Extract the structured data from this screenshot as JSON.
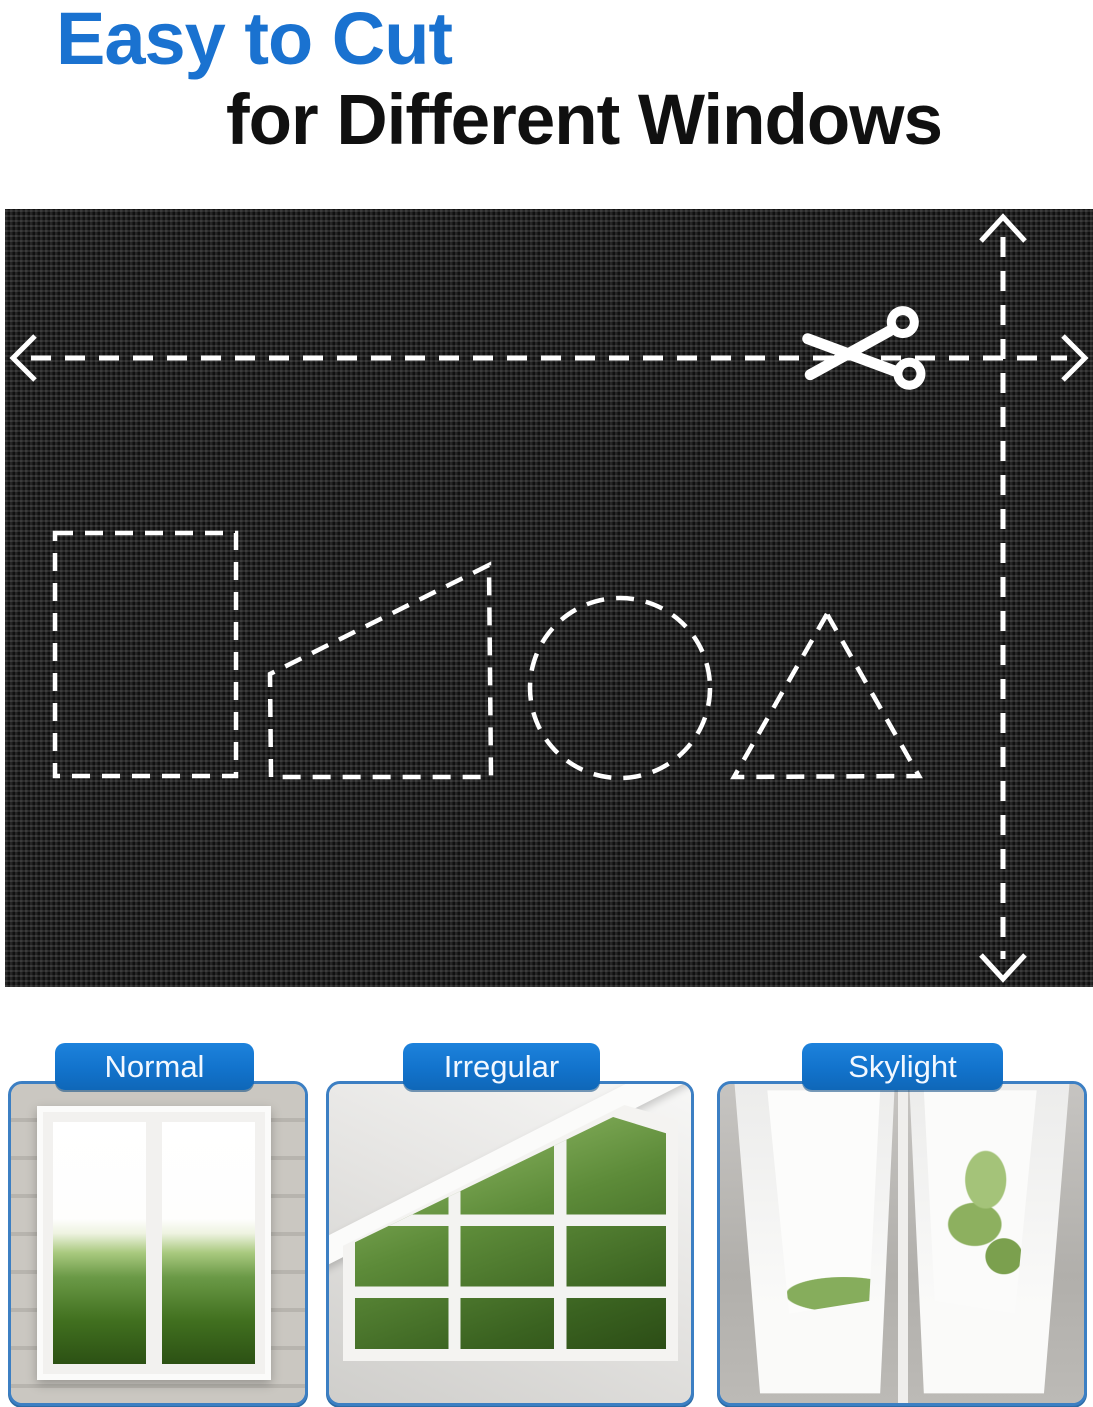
{
  "header": {
    "title_line1": "Easy to Cut",
    "title_line2": "for Different Windows"
  },
  "fabric_panel": {
    "icons": {
      "scissors": "scissors-icon",
      "horizontal_cut_arrow": "double-headed dashed arrow, horizontal",
      "vertical_cut_arrow": "double-headed dashed arrow, vertical"
    },
    "cut_shapes": [
      "rectangle",
      "trapezoid",
      "circle",
      "triangle"
    ]
  },
  "window_cards": [
    {
      "label": "Normal"
    },
    {
      "label": "Irregular"
    },
    {
      "label": "Skylight"
    }
  ],
  "colors": {
    "title_blue": "#1a72d0",
    "title_black": "#101010",
    "badge_blue": "#1273cc",
    "card_border_blue": "#3c7fc3",
    "fabric_black": "#1a1a1a",
    "guide_white": "#ffffff"
  }
}
